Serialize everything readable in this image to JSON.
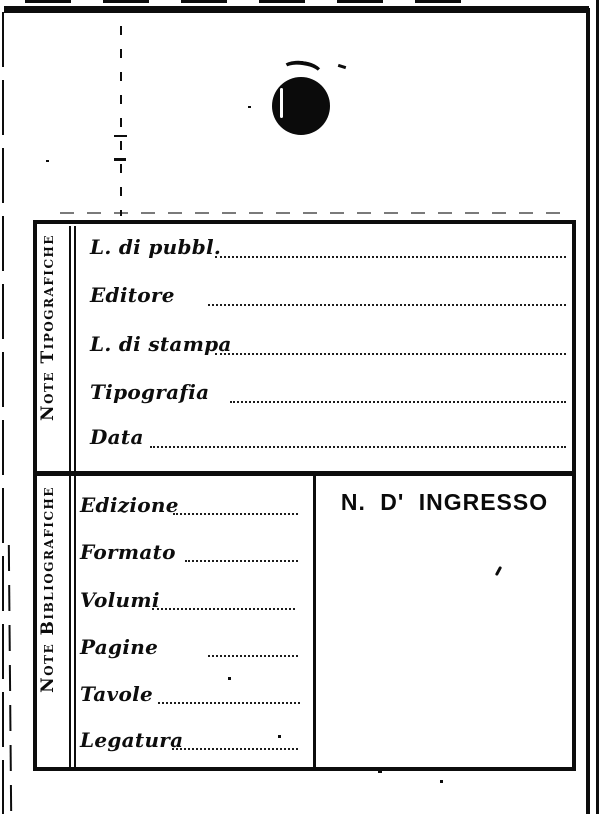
{
  "colors": {
    "ink": "#0d0d0d",
    "paper": "#ffffff"
  },
  "note_tipografiche": {
    "section_label": "Note Tipografiche",
    "fields": [
      {
        "label": "L. di pubbl.",
        "value": ""
      },
      {
        "label": "Editore",
        "value": ""
      },
      {
        "label": "L. di stampa",
        "value": ""
      },
      {
        "label": "Tipografia",
        "value": ""
      },
      {
        "label": "Data",
        "value": ""
      }
    ]
  },
  "note_bibliografiche": {
    "section_label": "Note Bibliografiche",
    "fields": [
      {
        "label": "Edizione",
        "value": ""
      },
      {
        "label": "Formato",
        "value": ""
      },
      {
        "label": "Volumi",
        "value": ""
      },
      {
        "label": "Pagine",
        "value": ""
      },
      {
        "label": "Tavole",
        "value": ""
      },
      {
        "label": "Legatura",
        "value": ""
      }
    ]
  },
  "ingresso": {
    "header": "N. D' INGRESSO",
    "value": ""
  }
}
